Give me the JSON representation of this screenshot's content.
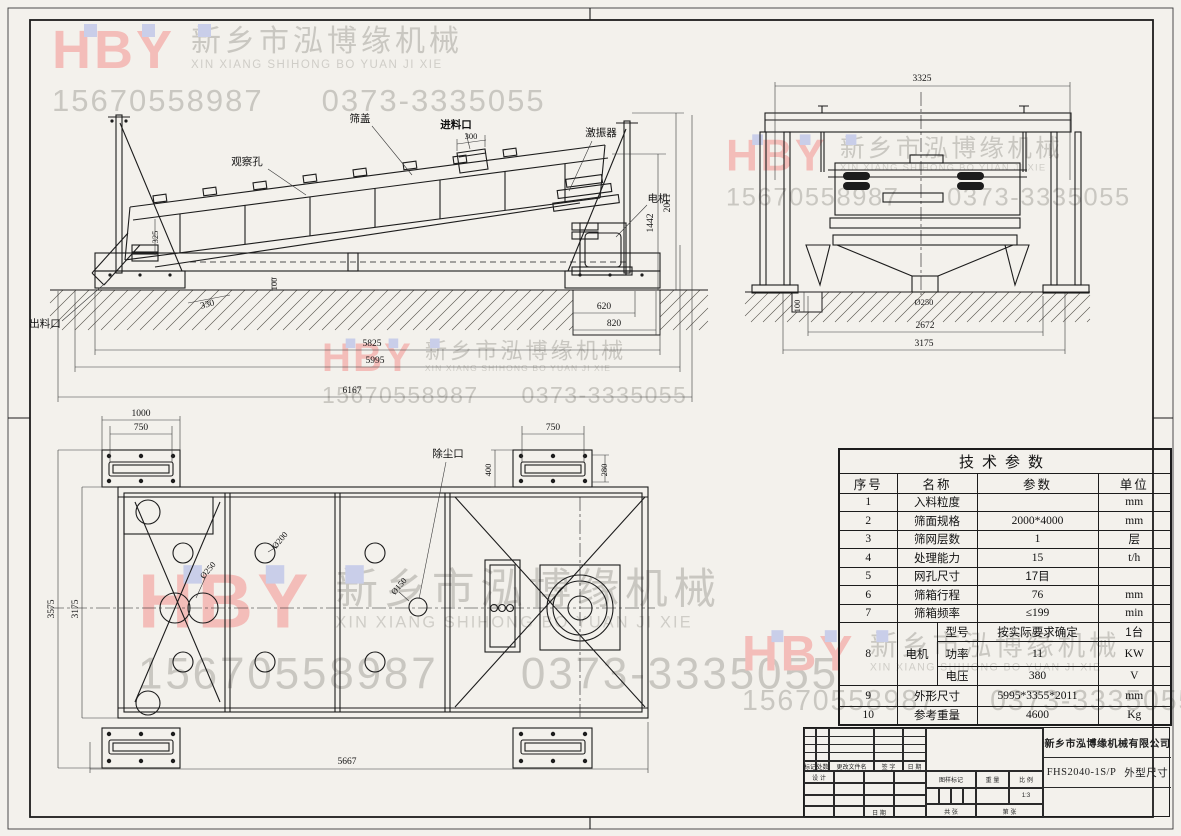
{
  "watermark": {
    "logo": "HBY",
    "company_cn": "新乡市泓博缘机械",
    "company_en": "XIN XIANG SHIHONG BO YUAN JI XIE",
    "phone1": "15670558987",
    "phone2": "0373-3335055"
  },
  "side_view": {
    "labels": {
      "observation": "观察孔",
      "cover": "筛盖",
      "inlet": "进料口",
      "exciter": "激振器",
      "motor": "电机",
      "outlet": "出料口"
    },
    "dims": {
      "inlet_width": "300",
      "d325": "325",
      "h1442": "1442",
      "h2011": "2011",
      "d330": "330",
      "d100": "100",
      "d620": "620",
      "d820": "820",
      "d5825": "5825",
      "d5995": "5995",
      "d6167": "6167"
    }
  },
  "end_view": {
    "dims": {
      "w3325": "3325",
      "dia250": "Ø250",
      "d100": "100",
      "w2672": "2672",
      "w3175": "3175"
    }
  },
  "plan_view": {
    "labels": {
      "dust": "除尘口"
    },
    "dims": {
      "d1000": "1000",
      "d750l": "750",
      "d750r": "750",
      "d400": "400",
      "d280": "280",
      "v3575": "3575",
      "v3175": "3175",
      "d5667": "5667",
      "dia250": "Ø250",
      "dia200": "Ø200",
      "dia150": "Ø150"
    }
  },
  "table": {
    "title": "技术参数",
    "headers": [
      "序号",
      "名称",
      "参数",
      "单位"
    ],
    "rows": [
      [
        "1",
        "入料粒度",
        "",
        "mm"
      ],
      [
        "2",
        "筛面规格",
        "2000*4000",
        "mm"
      ],
      [
        "3",
        "筛网层数",
        "1",
        "层"
      ],
      [
        "4",
        "处理能力",
        "15",
        "t/h"
      ],
      [
        "5",
        "网孔尺寸",
        "17目",
        ""
      ],
      [
        "6",
        "筛箱行程",
        "76",
        "mm"
      ],
      [
        "7",
        "筛箱频率",
        "≤199",
        "min"
      ]
    ],
    "motor_no": "8",
    "motor_label": "电机",
    "motor_rows": [
      [
        "型号",
        "按实际要求确定",
        "1台"
      ],
      [
        "功率",
        "11",
        "KW"
      ],
      [
        "电压",
        "380",
        "V"
      ]
    ],
    "tail_rows": [
      [
        "9",
        "外形尺寸",
        "5995*3355*2011",
        "mm"
      ],
      [
        "10",
        "参考重量",
        "4600",
        "Kg"
      ]
    ]
  },
  "title_block": {
    "company": "新乡市泓博缘机械有限公司",
    "drawing_no": "FHS2040-1S/P",
    "drawing_title": "外型尺寸",
    "rev_labels": [
      "标记",
      "处数",
      "更改文件名",
      "签 字",
      "日 期"
    ],
    "design": "设 计",
    "date": "日 期",
    "mark": "图样标记",
    "weight": "重 量",
    "scale": "比 例",
    "scale_value": "1:3",
    "sheets": "共 张",
    "sheet_no": "第 张"
  }
}
